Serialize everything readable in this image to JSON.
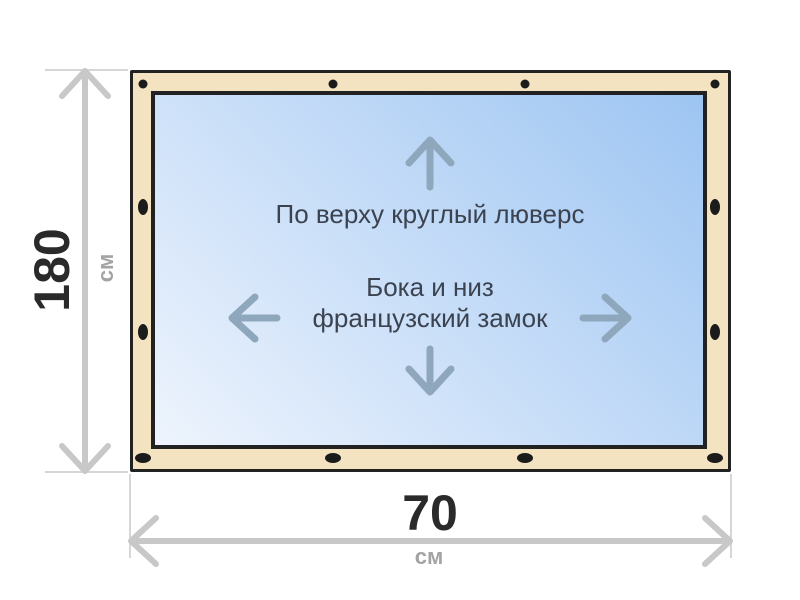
{
  "colors": {
    "ink": "#222222",
    "beige": "#f4e3c0",
    "panel_light": "#eef4fd",
    "panel_blue": "#9dc5f2",
    "grommet": "#1b1b1b",
    "dim": "#c8c8c8",
    "ext": "#d6d6d6",
    "arrow": "#8fa7bc",
    "label": "#3b4350",
    "number": "#2a2a2a",
    "unit": "#a3a3a3"
  },
  "diagram": {
    "labels": {
      "top_fastening": "По верху круглый люверс",
      "side_bottom_fastening_line1": "Бока и низ",
      "side_bottom_fastening_line2": "французский замок"
    },
    "dimensions": {
      "height": {
        "value": "180",
        "unit": "см"
      },
      "width": {
        "value": "70",
        "unit": "см"
      }
    },
    "grommets": {
      "top": {
        "shape": "circle",
        "y": 84,
        "xs": [
          143,
          333,
          525,
          715
        ]
      },
      "bottom": {
        "shape": "oval-horizontal",
        "y": 458,
        "xs": [
          143,
          333,
          525,
          715
        ]
      },
      "left": {
        "shape": "oval-vertical",
        "x": 143,
        "ys": [
          207,
          332
        ]
      },
      "right": {
        "shape": "oval-vertical",
        "x": 715,
        "ys": [
          207,
          332
        ]
      }
    }
  }
}
